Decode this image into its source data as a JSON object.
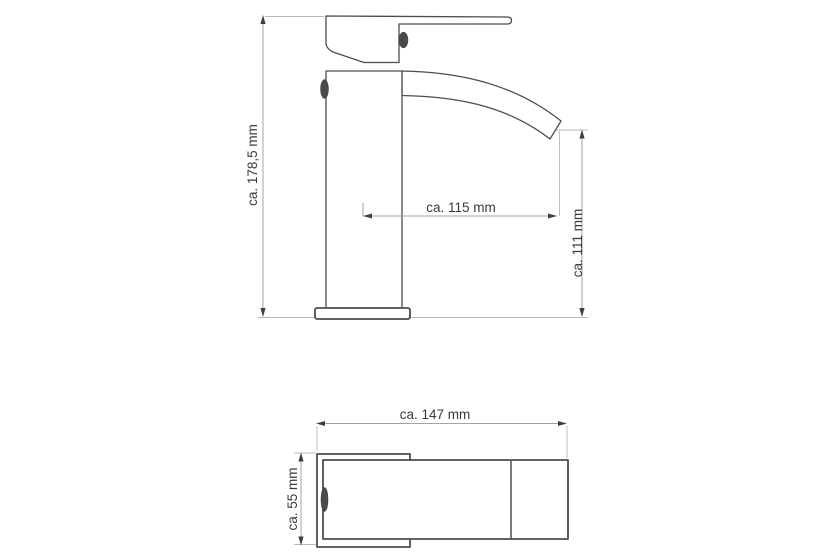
{
  "drawing": {
    "subject": "Waterfall basin mixer tap - dimensional technical drawing",
    "units": "mm",
    "side_view": {
      "name": "side view",
      "dimensions": [
        {
          "id": "total_height",
          "label": "ca. 178,5 mm",
          "orientation": "vertical"
        },
        {
          "id": "spout_reach",
          "label": "ca. 115 mm",
          "orientation": "horizontal"
        },
        {
          "id": "outlet_height",
          "label": "ca. 111 mm",
          "orientation": "vertical"
        }
      ]
    },
    "top_view": {
      "name": "top view",
      "dimensions": [
        {
          "id": "total_depth",
          "label": "ca. 147 mm",
          "orientation": "horizontal"
        },
        {
          "id": "base_width",
          "label": "ca. 55 mm",
          "orientation": "vertical"
        }
      ]
    },
    "colors": {
      "outline": "#4d4d4d",
      "dimension_line": "#a3a3a3",
      "text": "#3a3a3a",
      "background": "#ffffff"
    }
  }
}
